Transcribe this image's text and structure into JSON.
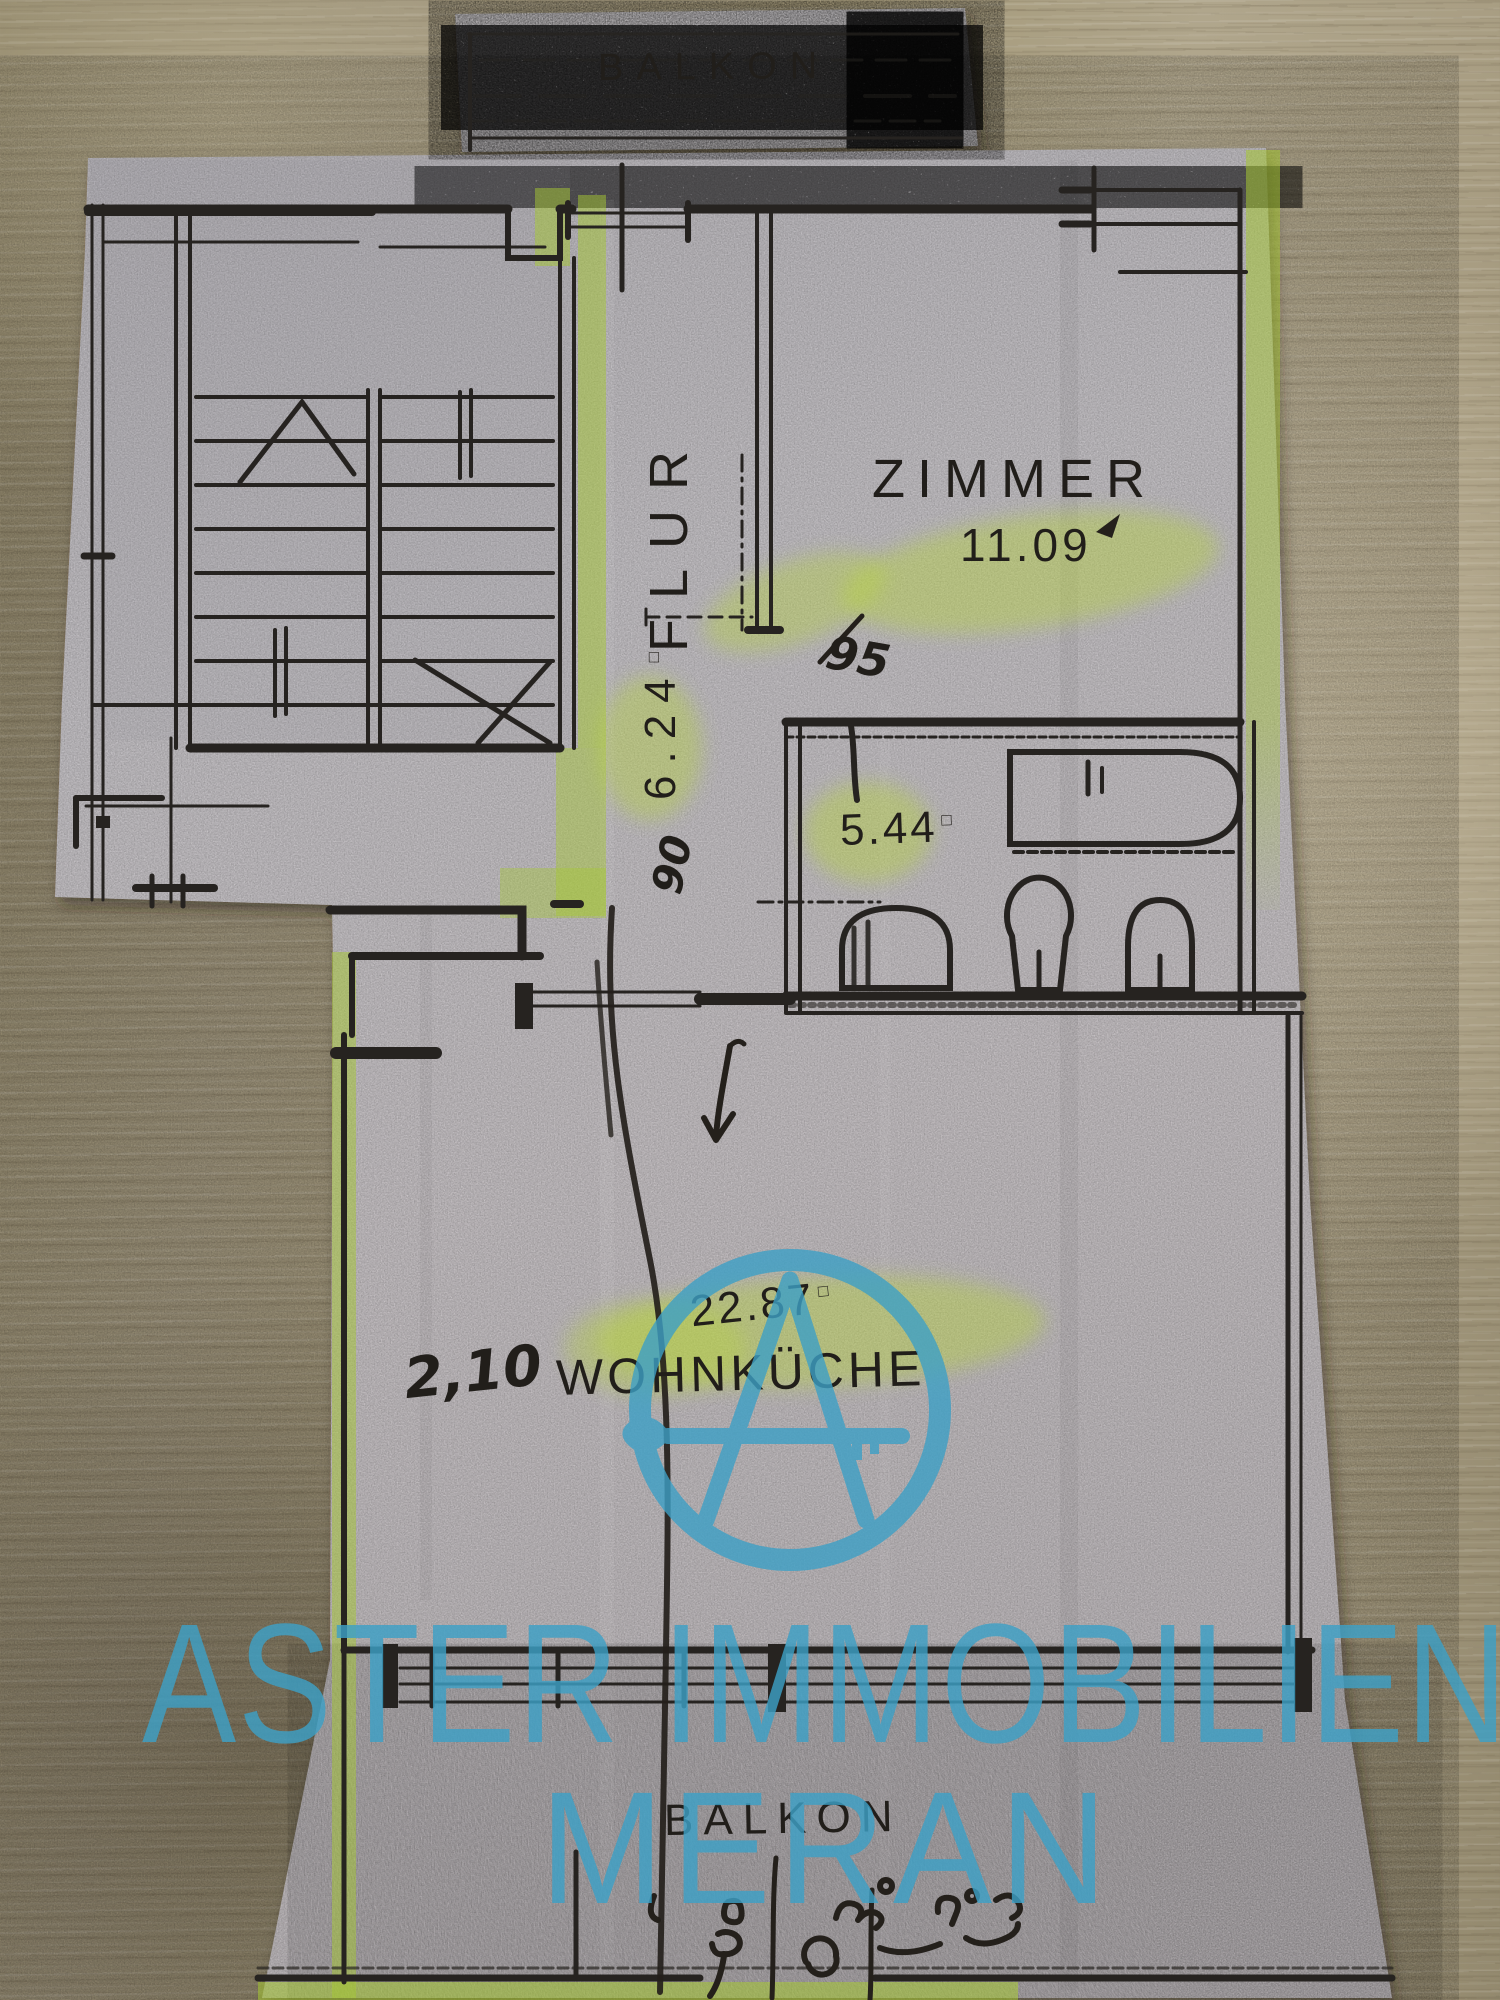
{
  "floorplan": {
    "balcony_top_label": "BALKON",
    "zimmer_label": "ZIMMER",
    "zimmer_area": "11.09",
    "flur_label": "FLUR",
    "flur_area": "6.24",
    "bath_area": "5.44",
    "kitchen_label": "WOHNKÜCHE",
    "kitchen_area": "22.87",
    "kitchen_width_note": "2,10",
    "door_width_note": "90",
    "pen_note": "95",
    "balcony_bottom_label": "BALKON",
    "area_unit_mark": "□"
  },
  "watermark": {
    "line1": "ASTER IMMOBILIEN",
    "line2": "MERAN",
    "color": "#3da0c6"
  },
  "colors": {
    "highlight": "#a6c832",
    "ink": "#262320",
    "paper": "#c7c4c8"
  }
}
